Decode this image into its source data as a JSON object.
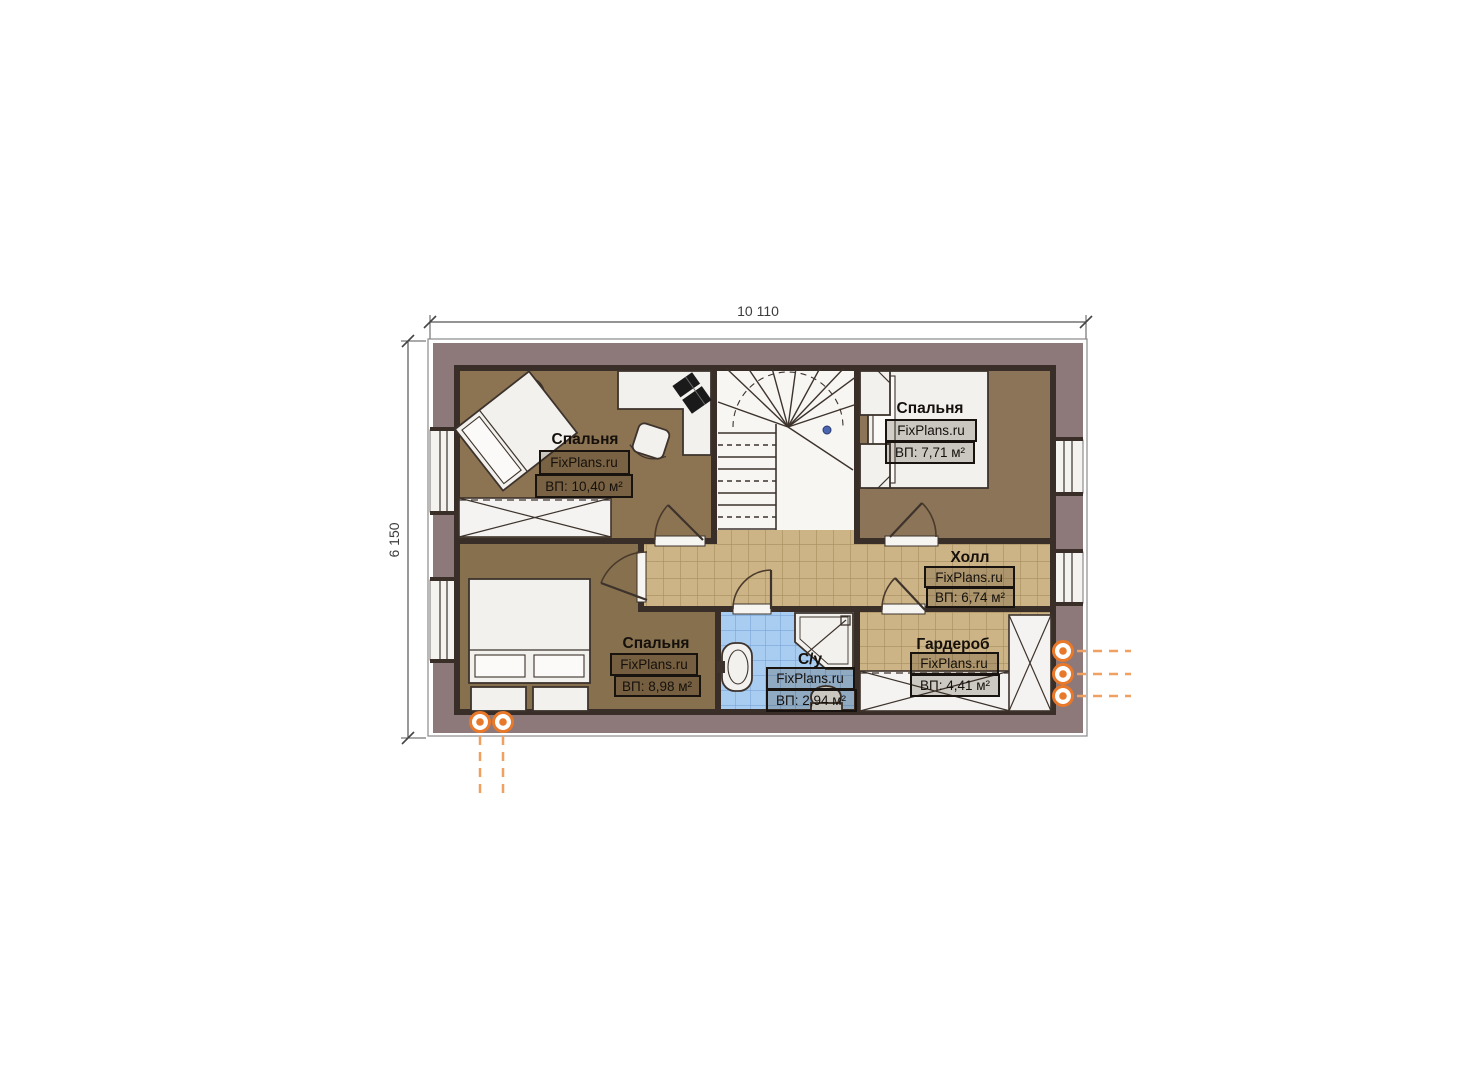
{
  "plan": {
    "dimensions": {
      "width_label": "10 110",
      "height_label": "6 150"
    },
    "rooms": [
      {
        "id": "bedroom-top-left",
        "name": "Спальня",
        "brand": "FixPlans.ru",
        "area": "ВП: 10,40 м²"
      },
      {
        "id": "bedroom-top-right",
        "name": "Спальня",
        "brand": "FixPlans.ru",
        "area": "ВП: 7,71 м²"
      },
      {
        "id": "hall",
        "name": "Холл",
        "brand": "FixPlans.ru",
        "area": "ВП: 6,74 м²"
      },
      {
        "id": "bedroom-bottom-left",
        "name": "Спальня",
        "brand": "FixPlans.ru",
        "area": "ВП: 8,98 м²"
      },
      {
        "id": "bathroom",
        "name": "С/у",
        "brand": "FixPlans.ru",
        "area": "ВП: 2,94 м²"
      },
      {
        "id": "wardrobe",
        "name": "Гардероб",
        "brand": "FixPlans.ru",
        "area": "ВП: 4,41 м²"
      }
    ],
    "colors": {
      "wall_fill": "#8d7979",
      "wall_line": "#3a2e29",
      "floor_bedroom": "#8a7354",
      "tile_hall": "#cdb486",
      "tile_bathroom": "#a9cdf1",
      "furniture_fill": "#f2f1ee",
      "accent_orange": "#e8782a"
    }
  }
}
